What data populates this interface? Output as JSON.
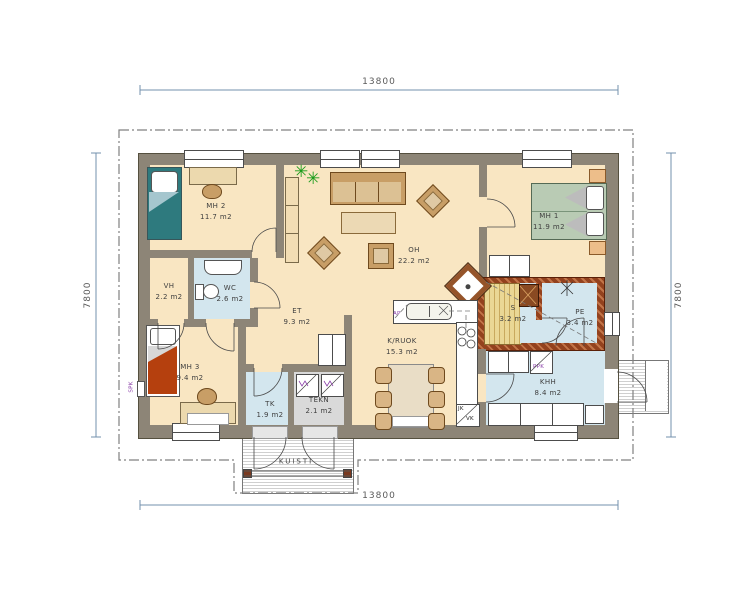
{
  "dimensions": {
    "top": "13800",
    "bottom": "13800",
    "left": "7800",
    "right": "7800"
  },
  "rooms": {
    "mh1": {
      "name": "MH 1",
      "area": "11.9 m2"
    },
    "mh2": {
      "name": "MH 2",
      "area": "11.7 m2"
    },
    "mh3": {
      "name": "MH 3",
      "area": "9.4 m2"
    },
    "oh": {
      "name": "OH",
      "area": "22.2 m2"
    },
    "et": {
      "name": "ET",
      "area": "9.3 m2"
    },
    "vh": {
      "name": "VH",
      "area": "2.2 m2"
    },
    "wc": {
      "name": "WC",
      "area": "2.6 m2"
    },
    "kruok": {
      "name": "K/RUOK",
      "area": "15.3 m2"
    },
    "tk": {
      "name": "TK",
      "area": "1.9 m2"
    },
    "tekn": {
      "name": "TEKN",
      "area": "2.1 m2"
    },
    "sauna": {
      "name": "S",
      "area": "3.2 m2"
    },
    "pe": {
      "name": "PE",
      "area": "3.4 m2"
    },
    "khh": {
      "name": "KHH",
      "area": "8.4 m2"
    },
    "kuisti": {
      "name": "KUISTI",
      "area": ""
    }
  },
  "labels": {
    "ap": "AP",
    "ppk": "PPK",
    "jk": "JK",
    "vk": "VK",
    "spk": "SPK"
  },
  "colors": {
    "wall": "#8d8577",
    "floor": "#f9e6c2",
    "wet_floor": "#d3e6ee",
    "sauna_wall": "#93421e",
    "sauna_bench": "#ead795",
    "tech_floor": "#d9d9d9",
    "bed_teal": "#2e7a7e",
    "bed_red": "#b5400e",
    "bed_green": "#b9cbb4",
    "wood": "#c89e66",
    "dimension_line": "#7390ad",
    "appliance_label": "#8a3fa8",
    "plant": "#1a9c1a"
  }
}
